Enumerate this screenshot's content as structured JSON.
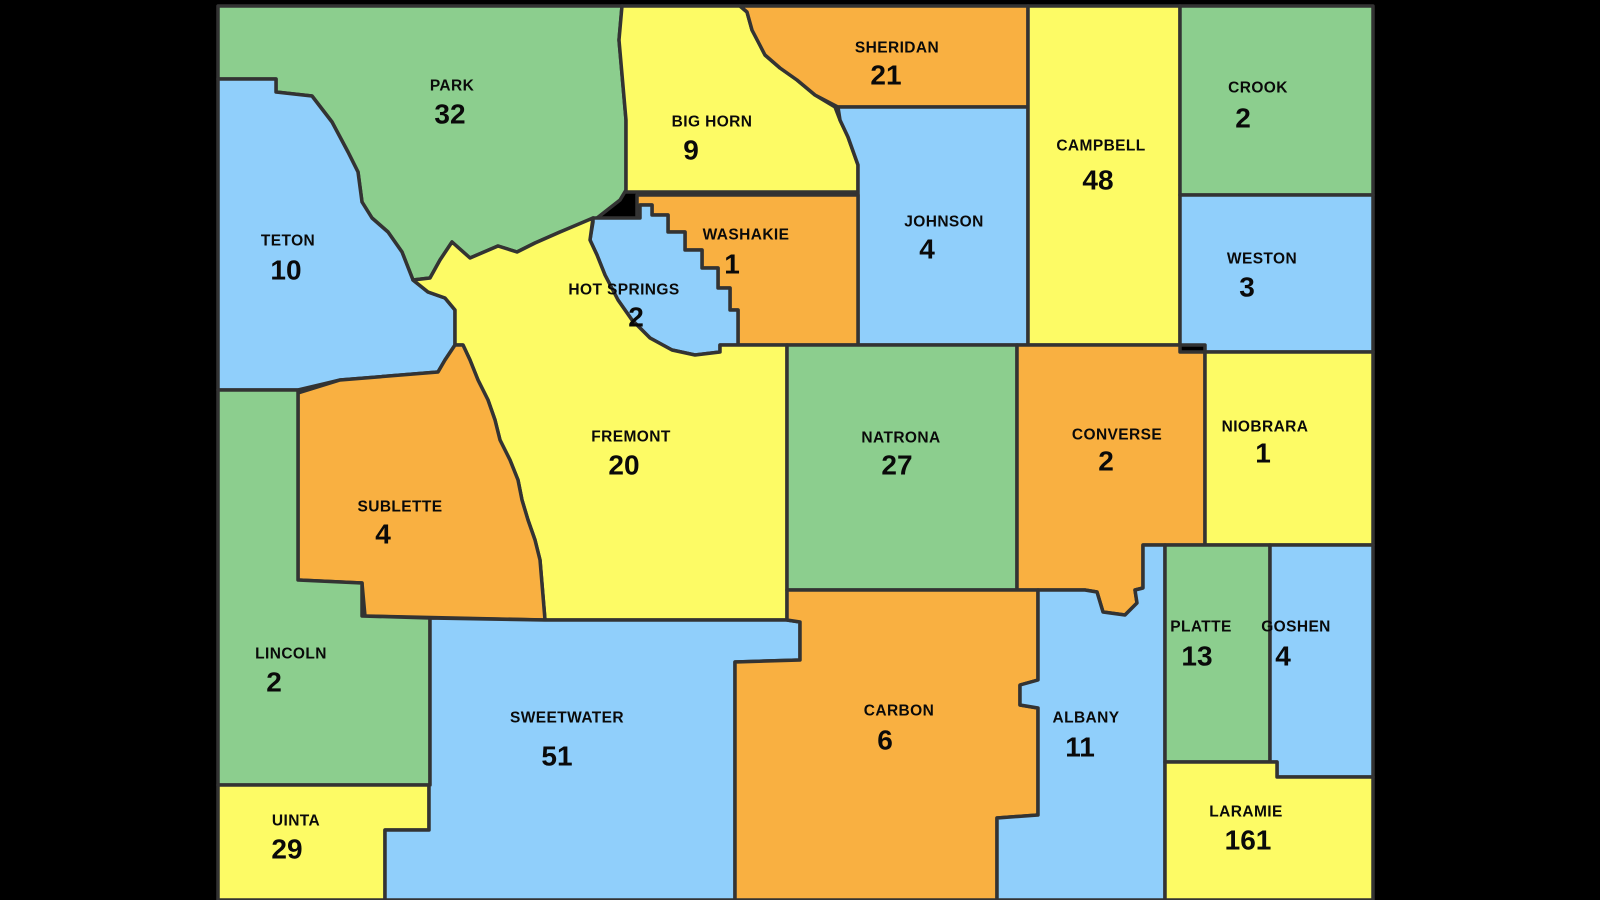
{
  "map_title": "Wyoming counties count map",
  "colors": {
    "green": "#8CCE8E",
    "yellow": "#FDFB65",
    "orange": "#F9B041",
    "blue": "#90CFFB",
    "border": "#333333",
    "background": "#000000",
    "label": "#0A0A0A"
  },
  "map": {
    "counties": [
      {
        "name": "PARK",
        "value": "32",
        "color": "green",
        "label_x": 452,
        "label_y": 86,
        "value_x": 450,
        "value_y": 114,
        "points": "218,6 622,6 619,40 626,120 626,190 620,200 597,218 560,232 535,243 517,252 498,246 470,258 452,242 440,260 430,278 413,280 402,252 388,232 372,218 362,202 358,172 348,152 332,122 312,96 276,92 276,79 218,79"
      },
      {
        "name": "TETON",
        "value": "10",
        "color": "blue",
        "label_x": 288,
        "label_y": 241,
        "value_x": 286,
        "value_y": 270,
        "points": "218,79 276,79 276,92 312,96 332,122 348,152 358,172 362,202 372,218 388,232 402,252 413,280 428,292 445,298 455,310 455,345 445,360 438,372 340,380 298,390 218,390"
      },
      {
        "name": "BIG HORN",
        "value": "9",
        "color": "yellow",
        "label_x": 712,
        "label_y": 122,
        "value_x": 691,
        "value_y": 150,
        "points": "622,6 740,6 747,12 752,30 760,45 765,55 780,68 797,80 815,95 835,107 840,120 848,137 858,165 858,192 626,192 626,120 619,40"
      },
      {
        "name": "SHERIDAN",
        "value": "21",
        "color": "orange",
        "label_x": 897,
        "label_y": 48,
        "value_x": 886,
        "value_y": 75,
        "points": "740,6 1028,6 1028,107 838,107 815,95 797,80 780,68 765,55 752,30 747,12"
      },
      {
        "name": "JOHNSON",
        "value": "4",
        "color": "blue",
        "label_x": 944,
        "label_y": 222,
        "value_x": 927,
        "value_y": 249,
        "points": "838,107 1028,107 1028,345 858,345 858,165 848,137 840,120"
      },
      {
        "name": "CAMPBELL",
        "value": "48",
        "color": "yellow",
        "label_x": 1101,
        "label_y": 146,
        "value_x": 1098,
        "value_y": 180,
        "points": "1028,6 1180,6 1180,345 1028,345"
      },
      {
        "name": "CROOK",
        "value": "2",
        "color": "green",
        "label_x": 1258,
        "label_y": 88,
        "value_x": 1243,
        "value_y": 118,
        "points": "1180,6 1373,6 1373,195 1180,195"
      },
      {
        "name": "WESTON",
        "value": "3",
        "color": "blue",
        "label_x": 1262,
        "label_y": 259,
        "value_x": 1247,
        "value_y": 287,
        "points": "1180,195 1373,195 1373,352 1205,352 1205,345 1180,345"
      },
      {
        "name": "WASHAKIE",
        "value": "1",
        "color": "orange",
        "label_x": 746,
        "label_y": 235,
        "value_x": 732,
        "value_y": 264,
        "points": "637,195 858,195 858,345 738,345 738,310 730,310 730,288 718,288 718,268 702,268 702,250 685,250 685,232 668,232 668,215 652,215 652,205 640,205 640,218 637,218"
      },
      {
        "name": "HOT SPRINGS",
        "value": "2",
        "color": "blue",
        "label_x": 624,
        "label_y": 290,
        "value_x": 636,
        "value_y": 317,
        "points": "593,218 640,218 640,205 652,205 652,215 668,215 668,232 685,232 685,250 702,250 702,268 718,268 718,288 730,288 730,310 738,310 738,345 720,345 720,352 695,355 672,350 650,338 632,320 618,300 605,275 597,255 590,240 593,222"
      },
      {
        "name": "FREMONT",
        "value": "20",
        "color": "yellow",
        "label_x": 631,
        "label_y": 437,
        "value_x": 624,
        "value_y": 465,
        "points": "413,280 430,278 440,260 452,242 470,258 498,246 517,252 535,243 560,232 593,218 590,240 597,255 605,275 618,300 632,320 650,338 672,350 695,355 720,352 720,345 787,345 787,620 545,620 540,560 535,540 528,520 522,500 518,480 510,460 500,440 495,420 488,400 478,380 470,360 463,345 455,345 455,310 445,298 428,292"
      },
      {
        "name": "NATRONA",
        "value": "27",
        "color": "green",
        "label_x": 901,
        "label_y": 438,
        "value_x": 897,
        "value_y": 465,
        "points": "787,345 1017,345 1017,590 787,590"
      },
      {
        "name": "CONVERSE",
        "value": "2",
        "color": "orange",
        "label_x": 1117,
        "label_y": 435,
        "value_x": 1106,
        "value_y": 461,
        "points": "1017,345 1180,345 1180,352 1205,352 1205,545 1143,545 1143,588 1135,590 1137,603 1125,615 1103,612 1097,592 1085,590 1017,590"
      },
      {
        "name": "NIOBRARA",
        "value": "1",
        "color": "yellow",
        "label_x": 1265,
        "label_y": 427,
        "value_x": 1263,
        "value_y": 453,
        "points": "1205,352 1373,352 1373,545 1205,545"
      },
      {
        "name": "SUBLETTE",
        "value": "4",
        "color": "orange",
        "label_x": 400,
        "label_y": 507,
        "value_x": 383,
        "value_y": 534,
        "points": "298,393 340,380 438,372 445,360 455,345 463,345 470,360 478,380 488,400 495,420 500,440 510,460 518,480 522,500 528,520 535,540 540,560 545,620 365,616 362,583 298,580"
      },
      {
        "name": "LINCOLN",
        "value": "2",
        "color": "green",
        "label_x": 291,
        "label_y": 654,
        "value_x": 274,
        "value_y": 682,
        "points": "218,390 298,390 298,580 362,583 362,616 430,618 430,785 218,785"
      },
      {
        "name": "UINTA",
        "value": "29",
        "color": "yellow",
        "label_x": 296,
        "label_y": 821,
        "value_x": 287,
        "value_y": 849,
        "points": "218,785 429,785 429,830 385,830 385,900 218,900"
      },
      {
        "name": "SWEETWATER",
        "value": "51",
        "color": "blue",
        "label_x": 567,
        "label_y": 718,
        "value_x": 557,
        "value_y": 756,
        "points": "430,618 545,620 787,620 800,622 800,660 735,662 735,900 385,900 385,830 429,830 429,785 430,785"
      },
      {
        "name": "CARBON",
        "value": "6",
        "color": "orange",
        "label_x": 899,
        "label_y": 711,
        "value_x": 885,
        "value_y": 740,
        "points": "787,590 1038,590 1038,680 1020,685 1020,705 1038,708 1038,815 997,818 997,900 735,900 735,662 800,660 800,622 787,620"
      },
      {
        "name": "ALBANY",
        "value": "11",
        "color": "blue",
        "label_x": 1086,
        "label_y": 718,
        "value_x": 1080,
        "value_y": 747,
        "points": "1038,590 1085,590 1097,592 1103,612 1125,615 1137,603 1135,590 1143,588 1143,545 1165,545 1165,900 997,900 997,818 1038,815 1038,708 1020,705 1020,685 1038,680"
      },
      {
        "name": "PLATTE",
        "value": "13",
        "color": "green",
        "label_x": 1201,
        "label_y": 627,
        "value_x": 1197,
        "value_y": 656,
        "points": "1165,545 1270,545 1270,762 1165,762"
      },
      {
        "name": "GOSHEN",
        "value": "4",
        "color": "blue",
        "label_x": 1296,
        "label_y": 627,
        "value_x": 1283,
        "value_y": 656,
        "points": "1270,545 1373,545 1373,777 1277,777 1277,762 1270,762"
      },
      {
        "name": "LARAMIE",
        "value": "161",
        "color": "yellow",
        "label_x": 1246,
        "label_y": 812,
        "value_x": 1248,
        "value_y": 840,
        "points": "1165,762 1277,762 1277,777 1373,777 1373,900 1165,900"
      }
    ]
  }
}
